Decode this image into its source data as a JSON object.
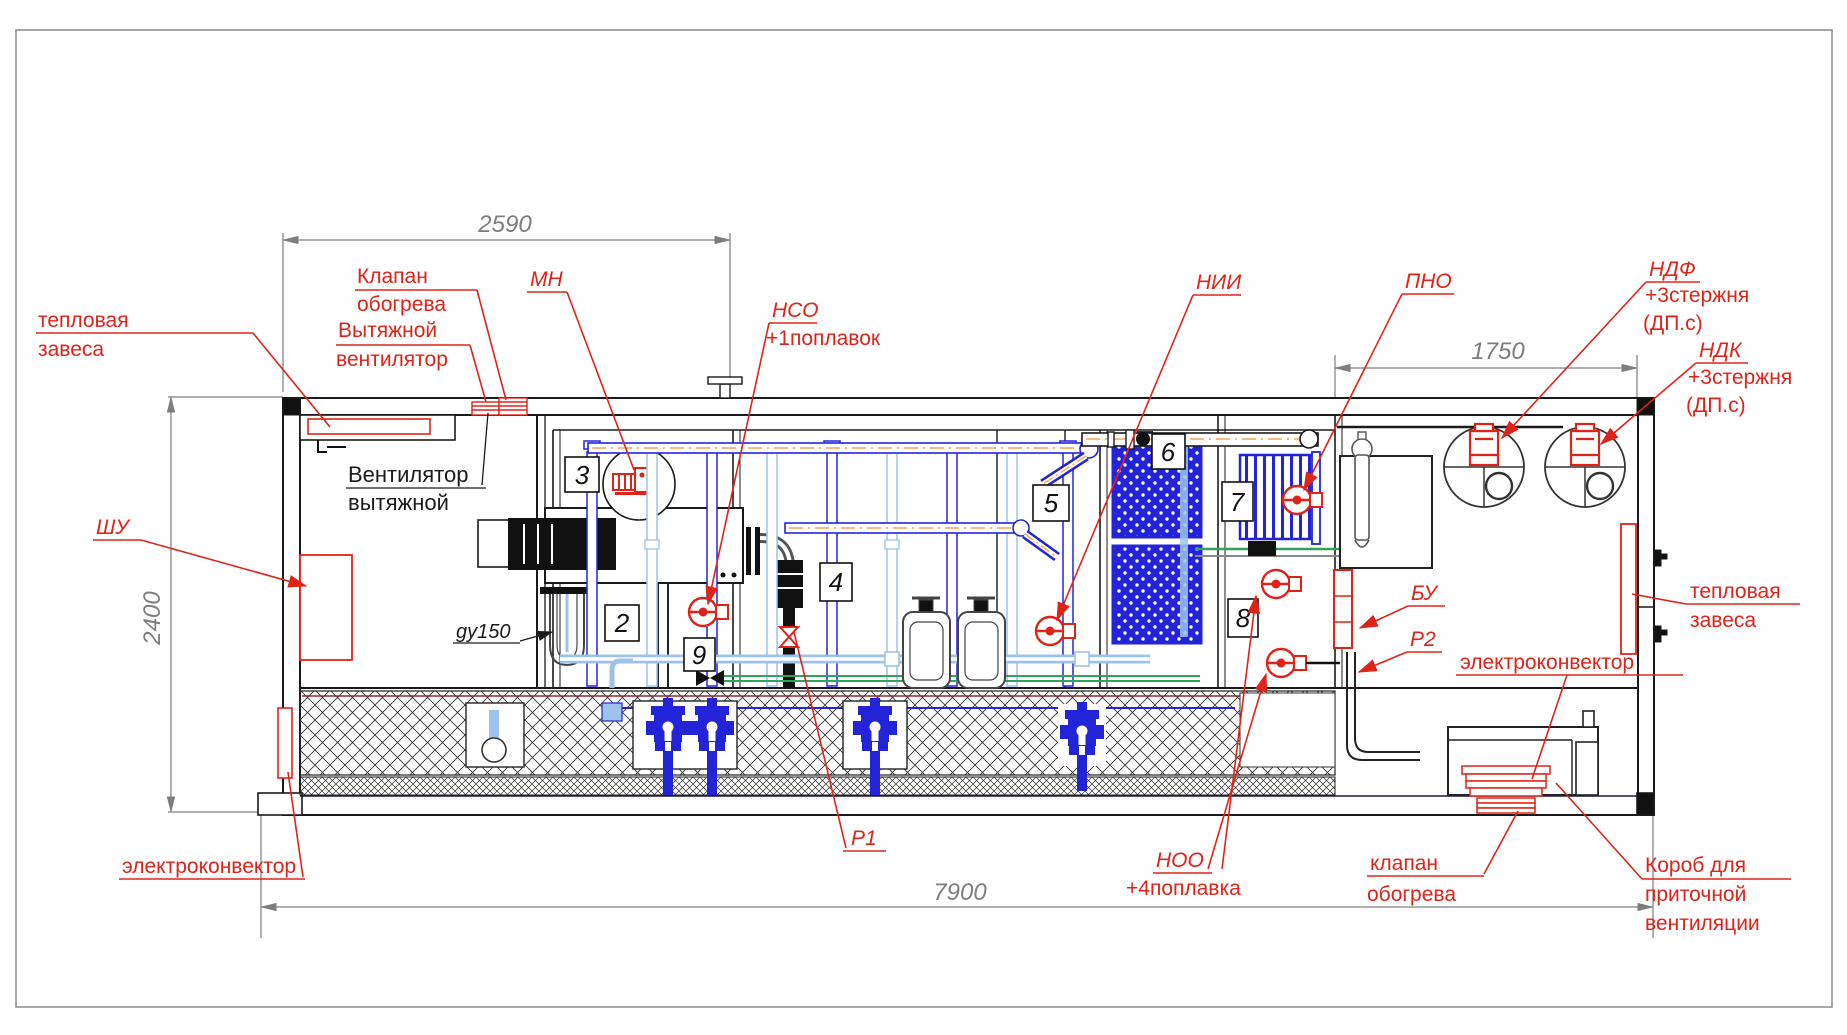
{
  "dimensions": {
    "width_left": "2590",
    "width_right": "1750",
    "height": "2400",
    "width_total": "7900"
  },
  "rooms": {
    "r2": "2",
    "r3": "3",
    "r4": "4",
    "r5": "5",
    "r6": "6",
    "r7": "7",
    "r8": "8",
    "r9": "9"
  },
  "labels_red": {
    "thermal_curtain_left_1": "тепловая",
    "thermal_curtain_left_2": "завеса",
    "heating_valve_top_1": "Клапан",
    "heating_valve_top_2": "обогрева",
    "exhaust_fan_red_1": "Вытяжной",
    "exhaust_fan_red_2": "вентилятор",
    "mn": "МН",
    "nso": "НСО",
    "nso_note": "+1поплавок",
    "nii": "НИИ",
    "pno": "ПНО",
    "ndf": "НДФ",
    "ndf_note": "+3стержня",
    "ndf_note2": "(ДП.с)",
    "ndk": "НДК",
    "ndk_note": "+3стержня",
    "ndk_note2": "(ДП.с)",
    "shu": "ШУ",
    "bu": "БУ",
    "r2_valve": "Р2",
    "r1_valve": "Р1",
    "noo": "НОО",
    "noo_note": "+4поплавка",
    "heater_right": "электроконвектор",
    "thermal_curtain_right_1": "тепловая",
    "thermal_curtain_right_2": "завеса",
    "heating_valve_bottom_1": "клапан",
    "heating_valve_bottom_2": "обогрева",
    "supply_duct_1": "Короб для",
    "supply_duct_2": "приточной",
    "supply_duct_3": "вентиляции",
    "heater_left": "электроконвектор"
  },
  "labels_black": {
    "exhaust_fan_1": "Вентилятор",
    "exhaust_fan_2": "вытяжной",
    "pipe_dn": "gy150"
  },
  "colors": {
    "annotation_red": "#e02319",
    "pipe_blue": "#2323d8",
    "pipe_light_blue": "#9dc3ea",
    "pipe_green": "#2fa45a",
    "air_orange": "#f2a654",
    "dimension_gray": "#7d7d7d",
    "line_black": "#1a1a1a",
    "heat_cable_maroon": "#8b2b2b"
  }
}
